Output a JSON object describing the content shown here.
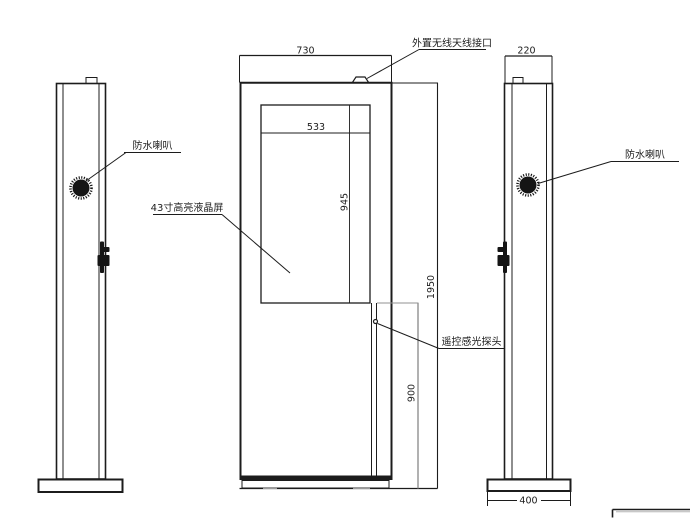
{
  "labels": {
    "waterproof_speaker_left": "防水喇叭",
    "waterproof_speaker_right": "防水喇叭",
    "antenna_port": "外置无线天线接口",
    "lcd_screen": "43寸高亮液晶屏",
    "light_sensor": "遥控感光探头"
  },
  "dimensions": {
    "cabinet_width": "730",
    "screen_width": "533",
    "screen_height": "945",
    "total_height": "1950",
    "lower_section_height": "900",
    "side_depth": "220",
    "base_depth": "400"
  },
  "colors": {
    "line": "#1c1c1c",
    "dim_gray": "#909090",
    "background": "#ffffff"
  }
}
